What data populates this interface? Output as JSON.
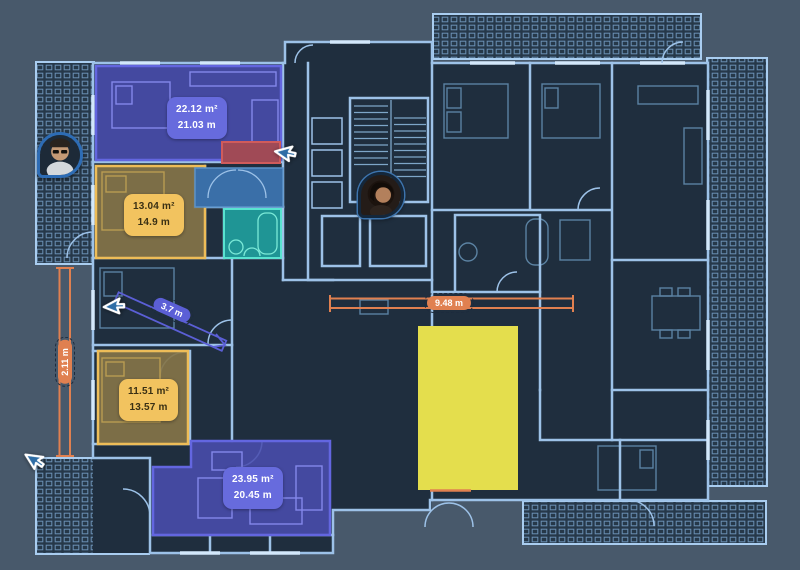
{
  "canvas": {
    "background": "#48596b",
    "plan_fill": "#1f2e3e",
    "wall_color": "#9dc2e8"
  },
  "rooms": [
    {
      "label": "room-top-left",
      "area": "22.12 m²",
      "perimeter": "21.03 m",
      "highlight_color": "#4a4dae",
      "badge_color": "#676bdd"
    },
    {
      "label": "room-mid-left",
      "area": "13.04 m²",
      "perimeter": "14.9 m",
      "highlight_color": "#847448",
      "badge_color": "#f2c35f"
    },
    {
      "label": "room-lower-left",
      "area": "11.51 m²",
      "perimeter": "13.57 m",
      "highlight_color": "#847448",
      "badge_color": "#f2c35f"
    },
    {
      "label": "room-bottom",
      "area": "23.95 m²",
      "perimeter": "20.45 m",
      "highlight_color": "#4a4dae",
      "badge_color": "#676bdd"
    }
  ],
  "zones": [
    {
      "label": "bathroom-teal",
      "color": "#1f9595"
    },
    {
      "label": "red-block",
      "color": "#a04a56"
    },
    {
      "label": "hallway-blue",
      "color": "#3a6fa8"
    },
    {
      "label": "yellow-block",
      "color": "#e4de4d"
    }
  ],
  "measurements": [
    {
      "label": "width-measure",
      "value": "9.48 m",
      "color": "#e08050"
    },
    {
      "label": "vertical-measure",
      "value": "2.11 m",
      "color": "#e08050"
    },
    {
      "label": "diagonal-measure",
      "value": "3.7 m",
      "color": "#5b5fd6"
    }
  ],
  "presence": {
    "cursor_color": "#2e6da6",
    "avatars": [
      {
        "label": "collaborator-1"
      },
      {
        "label": "collaborator-2"
      }
    ]
  }
}
